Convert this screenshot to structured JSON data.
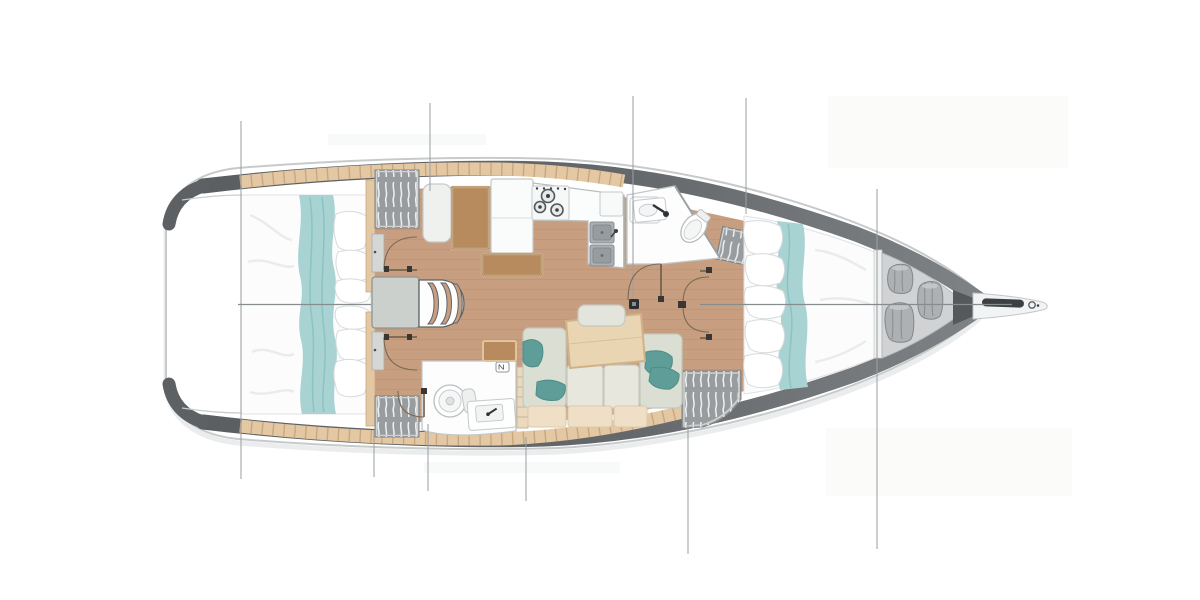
{
  "palette": {
    "page_bg": "#ffffff",
    "hull_fill": "#ffffff",
    "hull_outline": "#c7cacb",
    "bulwark_dark": "#5a5e61",
    "bulwark_light": "#7f8386",
    "floor_wood": "#c79f80",
    "plank_line": "#a87f60",
    "trim_wood": "#e3c8a3",
    "trim_tick": "#c2a076",
    "furniture_brown": "#b88b5f",
    "furniture_brown_edge": "#e0c59c",
    "table_wood": "#e9d5b2",
    "table_edge": "#cfb288",
    "bed_white": "#fcfcfd",
    "bed_shadow": "#e8eaec",
    "teal_runner": "#a8d3d2",
    "teal_streak": "#8cc3c2",
    "teal_pillow": "#5f9d99",
    "sofa_back": "#dbded3",
    "sofa_seat": "#e8e7dd",
    "sofa_bench": "#eedfc6",
    "platform_gray": "#ccd0cd",
    "wardrobe_gray": "#989c9e",
    "wardrobe_edge": "#cdd1d1",
    "counter_white": "#fbfcfc",
    "counter_edge": "#b9bdbe",
    "steel": "#a9afb2",
    "steel_dark": "#888e91",
    "appliance_dark": "#3c4042",
    "bath_white": "#fdfdfe",
    "bath_edge": "#c3c7c8",
    "locker_floor": "#d0d2d4",
    "bag_gray": "#aeb1b3",
    "bag_edge": "#83878a",
    "rig_line": "#9ba0a3",
    "center_line": "#878c8f",
    "door_arc": "#7a6a52",
    "door_leaf": "#6b5b46",
    "hinge_dark": "#3a3633",
    "mast_dark": "#2c2f31",
    "ghost": "#b9b3ad"
  },
  "scene": {
    "aft_cabins": 2,
    "forward_cabins": 1,
    "heads": 2,
    "stove_burners": 3,
    "sink_basins": 2,
    "companionway_steps": 3,
    "bow_locker_bags": 3,
    "teal_accent_pillows": 4,
    "station_lines_x": [
      241,
      429,
      633,
      746,
      877
    ],
    "centerline_y": 304
  }
}
